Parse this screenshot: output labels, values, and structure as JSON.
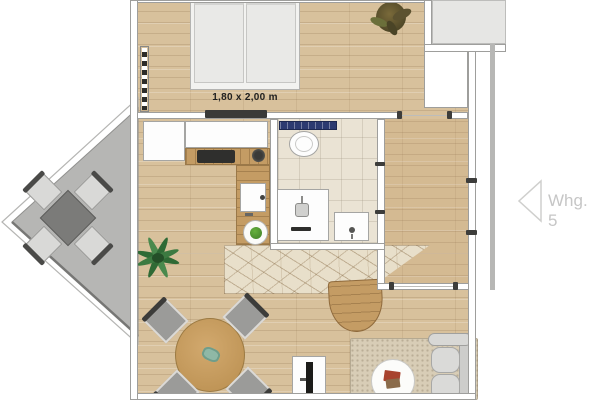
{
  "floor_plan": {
    "bed_dimension_label": "1,80 x 2,00 m",
    "apartment_nav": {
      "label": "Whg. 5"
    },
    "colors": {
      "wood_floor": "#d8c19c",
      "kitchen_counter_wood": "#c49c64",
      "bathroom_floor": "#eae3d4",
      "bathroom_wall_tiles": "#2c3a70",
      "balcony_floor": "#b6b6b4",
      "wall": "#ffffff",
      "wall_edge": "#9e9e9c",
      "neighbor_unit": "#e6e6e6",
      "sofa": "#d8d8d6",
      "dining_table": "#c99e5f",
      "chair": "#9b9b99",
      "nav_text": "#c6c6c6"
    },
    "furniture_icons": [
      "double-bed-icon",
      "radiator-icon",
      "sideboard-icon",
      "plant-icon",
      "kitchen-cabinet-icon",
      "cooktop-icon",
      "kitchen-sink-icon",
      "fruit-bowl-icon",
      "toilet-icon",
      "shower-icon",
      "bathroom-sink-icon",
      "dining-table-icon",
      "dining-chair-icon",
      "area-rug-icon",
      "side-table-icon",
      "tv-sideboard-icon",
      "coffee-table-icon",
      "sofa-icon",
      "balcony-table-icon",
      "balcony-chair-icon"
    ]
  }
}
